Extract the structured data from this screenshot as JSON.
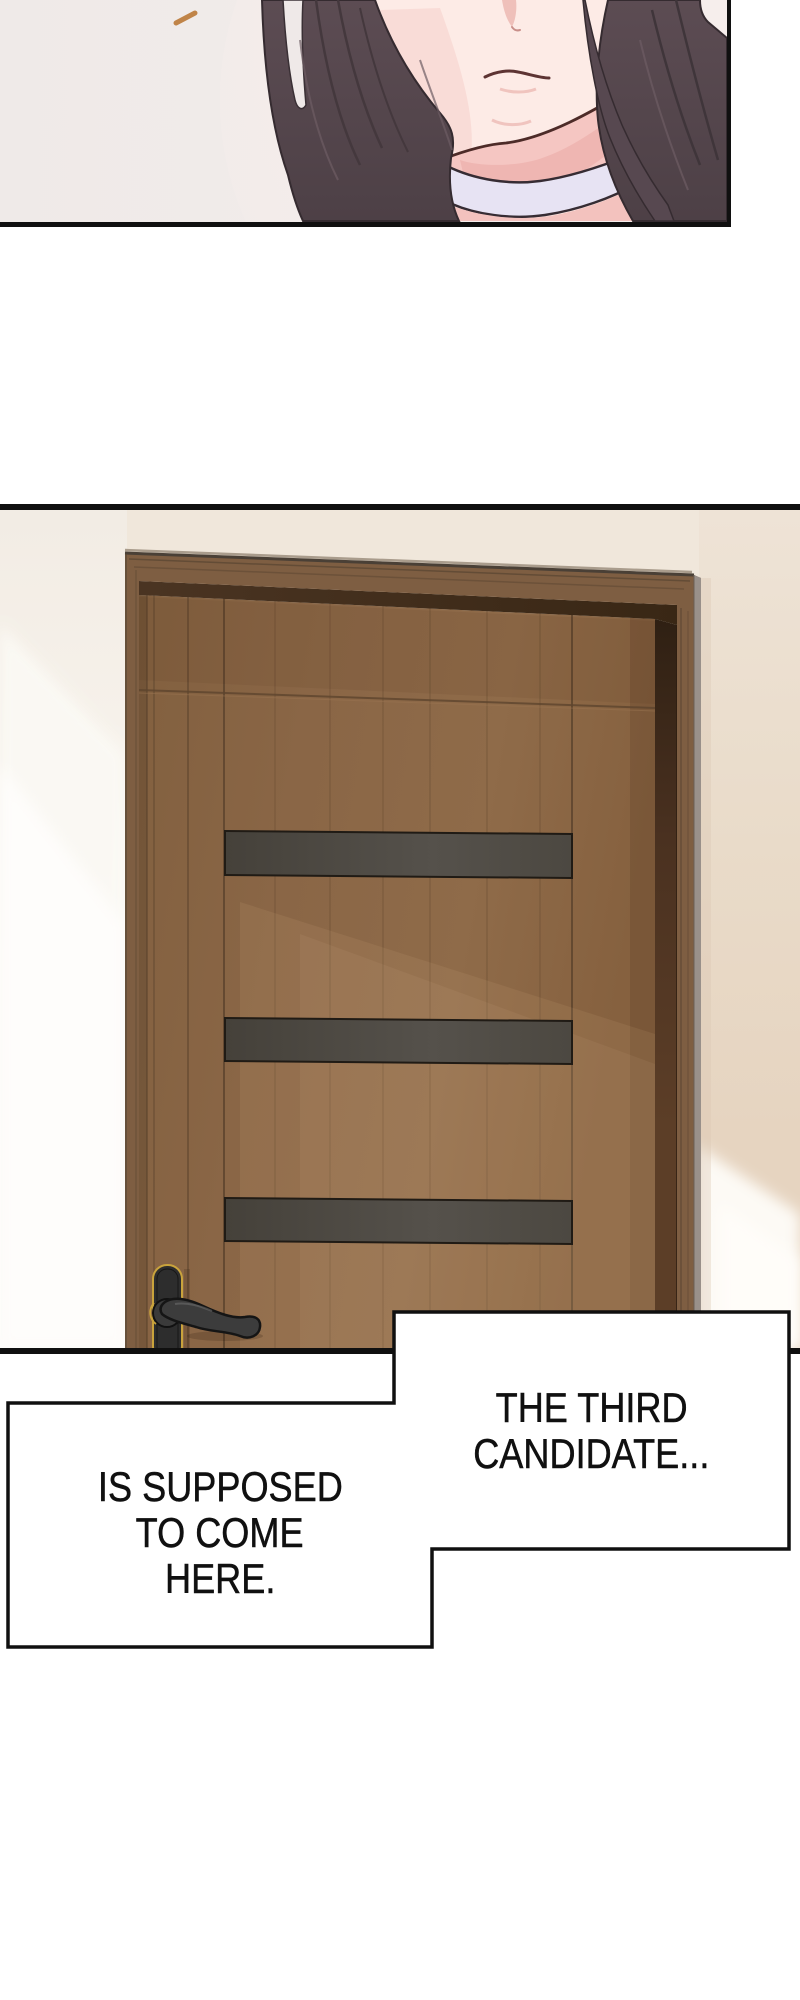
{
  "bubbles": {
    "right": {
      "lines": [
        "THE THIRD",
        "CANDIDATE..."
      ]
    },
    "left": {
      "lines": [
        "IS SUPPOSED",
        "TO COME",
        "HERE."
      ]
    }
  },
  "colors": {
    "page_bg": "#ffffff",
    "ink": "#101010",
    "panel1_bg": "#f1ebe9",
    "hair": "#55464d",
    "hair_dark": "#362c31",
    "hair_light": "#6e5c64",
    "skin": "#fdebe6",
    "skin_shadow": "#f5c6c2",
    "skin_deep": "#edb2ae",
    "lip_line": "#5d3433",
    "choker": "#e7e3f3",
    "choker_line": "#362c33",
    "accent_dash": "#c08448",
    "wall": "#f0e7db",
    "wall_tan": "#e9dbc9",
    "wall_light": "#fdfbf6",
    "door_wood": "#8a6646",
    "door_frame": "#7e5e42",
    "door_seam": "#5e452e",
    "door_stripe": "#4e4a43",
    "door_gap": "#3a2817",
    "handle_metal": "#3c3c3c",
    "handle_gold": "#c9a33c",
    "bubble_bg": "#ffffff"
  }
}
